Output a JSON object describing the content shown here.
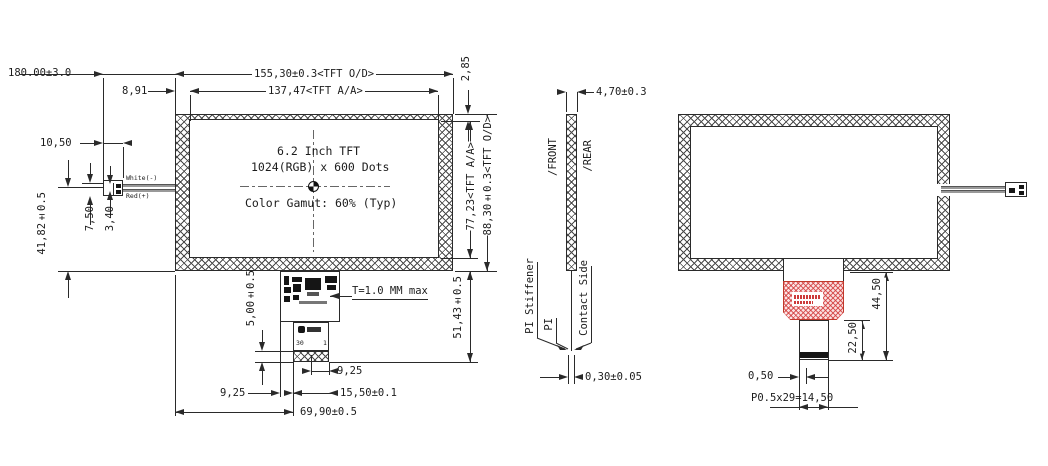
{
  "drawing": {
    "front": {
      "display_line1": "6.2 Inch TFT",
      "display_line2": "1024(RGB) x 600 Dots",
      "display_line3": "Color Gamut: 60% (Typ)",
      "dim_overall": "180.00±3.0",
      "dim_od_width": "155,30±0.3<TFT O/D>",
      "dim_aa_width": "137,47<TFT A/A>",
      "dim_left_border": "8,91",
      "dim_top_border": "2,85",
      "dim_aa_height": "77,23<TFT A/A>",
      "dim_od_height": "88,30±0.3<TFT O/D>",
      "dim_connector": "10,50",
      "dim_wire_pos": "41,82±0.5",
      "dim_wire_a": "7,50",
      "dim_wire_b": "3,40",
      "wire_white": "White(-)",
      "wire_red": "Red(+)",
      "fpc_thickness": "T=1.0 MM max",
      "dim_contact": "5,00±0.5",
      "dim_fpc_right": "9,25",
      "dim_fpc_left": "9,25",
      "dim_tab_width": "15,50±0.1",
      "dim_fpc_offset": "69,90±0.5",
      "dim_fpc_length": "51,43±0.5",
      "pin_first": "30",
      "pin_last": "1"
    },
    "side": {
      "dim_thickness": "4,70±0.3",
      "front_surface": "/FRONT",
      "rear_surface": "/REAR",
      "pi_stiffener": "PI Stiffener",
      "pi": "PI",
      "contact_side": "Contact Side",
      "dim_stiffener": "0,30±0.05"
    },
    "rear": {
      "dim_fpc_total": "44,50",
      "dim_tail": "22,50",
      "dim_contact_margin": "0,50",
      "dim_pitch": "P0.5x29=14,50"
    },
    "colors": {
      "line": "#2a2a2a",
      "red_fpc": "#cc3b3b",
      "wire": "#999999"
    }
  }
}
